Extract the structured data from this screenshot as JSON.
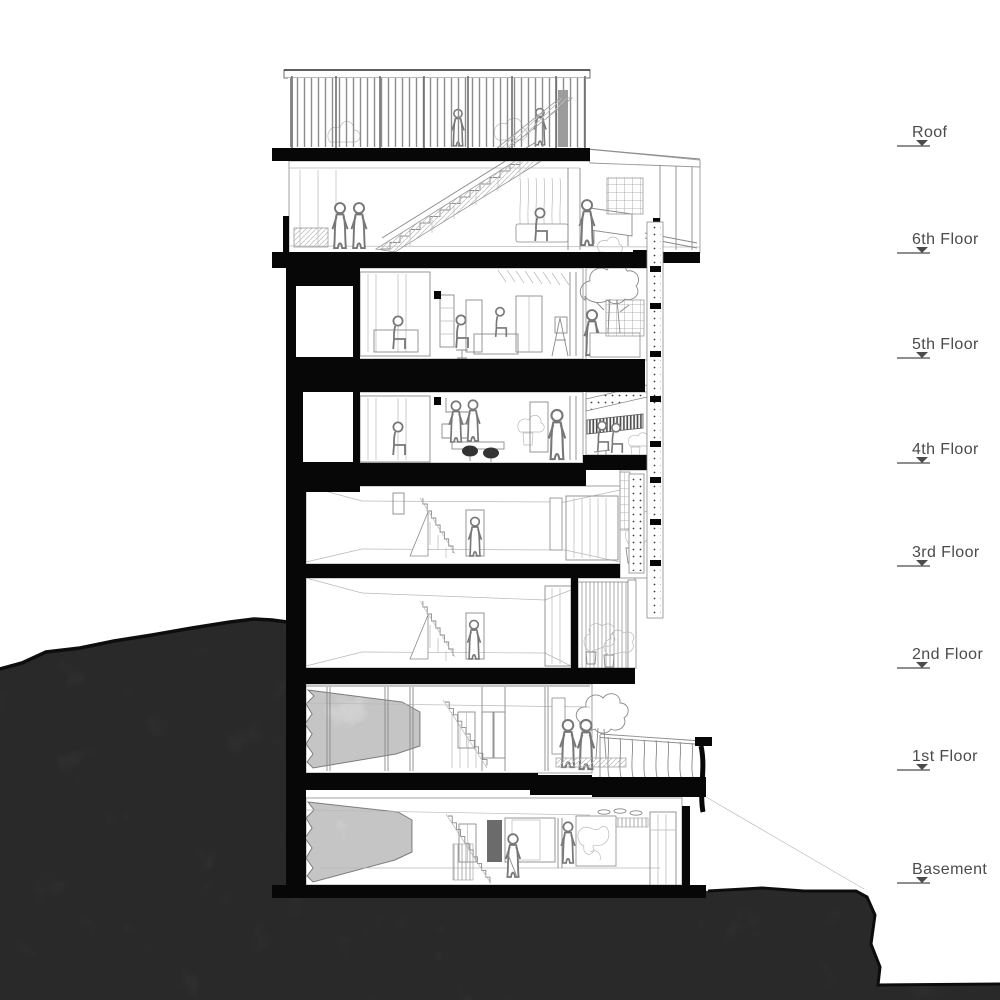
{
  "levels": [
    {
      "label": "Roof"
    },
    {
      "label": "6th Floor"
    },
    {
      "label": "5th Floor"
    },
    {
      "label": "4th Floor"
    },
    {
      "label": "3rd Floor"
    },
    {
      "label": "2nd Floor"
    },
    {
      "label": "1st Floor"
    },
    {
      "label": "Basement"
    }
  ],
  "colors": {
    "terrain": "#3e3e3e",
    "section_poche": "#070707",
    "line_art": "#8a8a8a",
    "label_text": "#4b4b4b",
    "background": "#ffffff"
  }
}
